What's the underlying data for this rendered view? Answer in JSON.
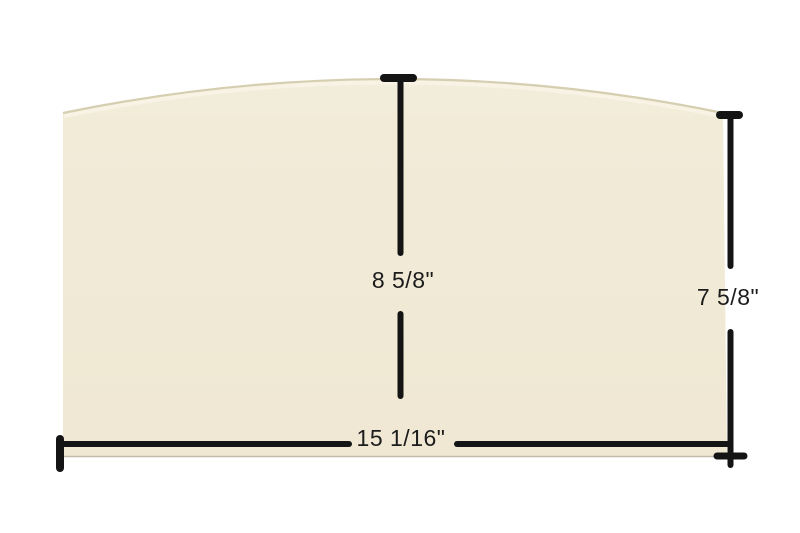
{
  "diagram": {
    "title": "Arched glass panel dimension diagram",
    "labels": {
      "center_height": "8 5/8\"",
      "right_height": "7 5/8\"",
      "bottom_width": "15 1/16\""
    },
    "colors": {
      "background": "#ffffff",
      "panel_fill": "#f0e9d5",
      "panel_top_edge": "#d6ceb1",
      "panel_bevel_highlight": "#f8f3e4",
      "panel_bottom_edge": "#c1bbaa",
      "dimension_line": "#141414",
      "label_text": "#1c1c1c"
    }
  }
}
